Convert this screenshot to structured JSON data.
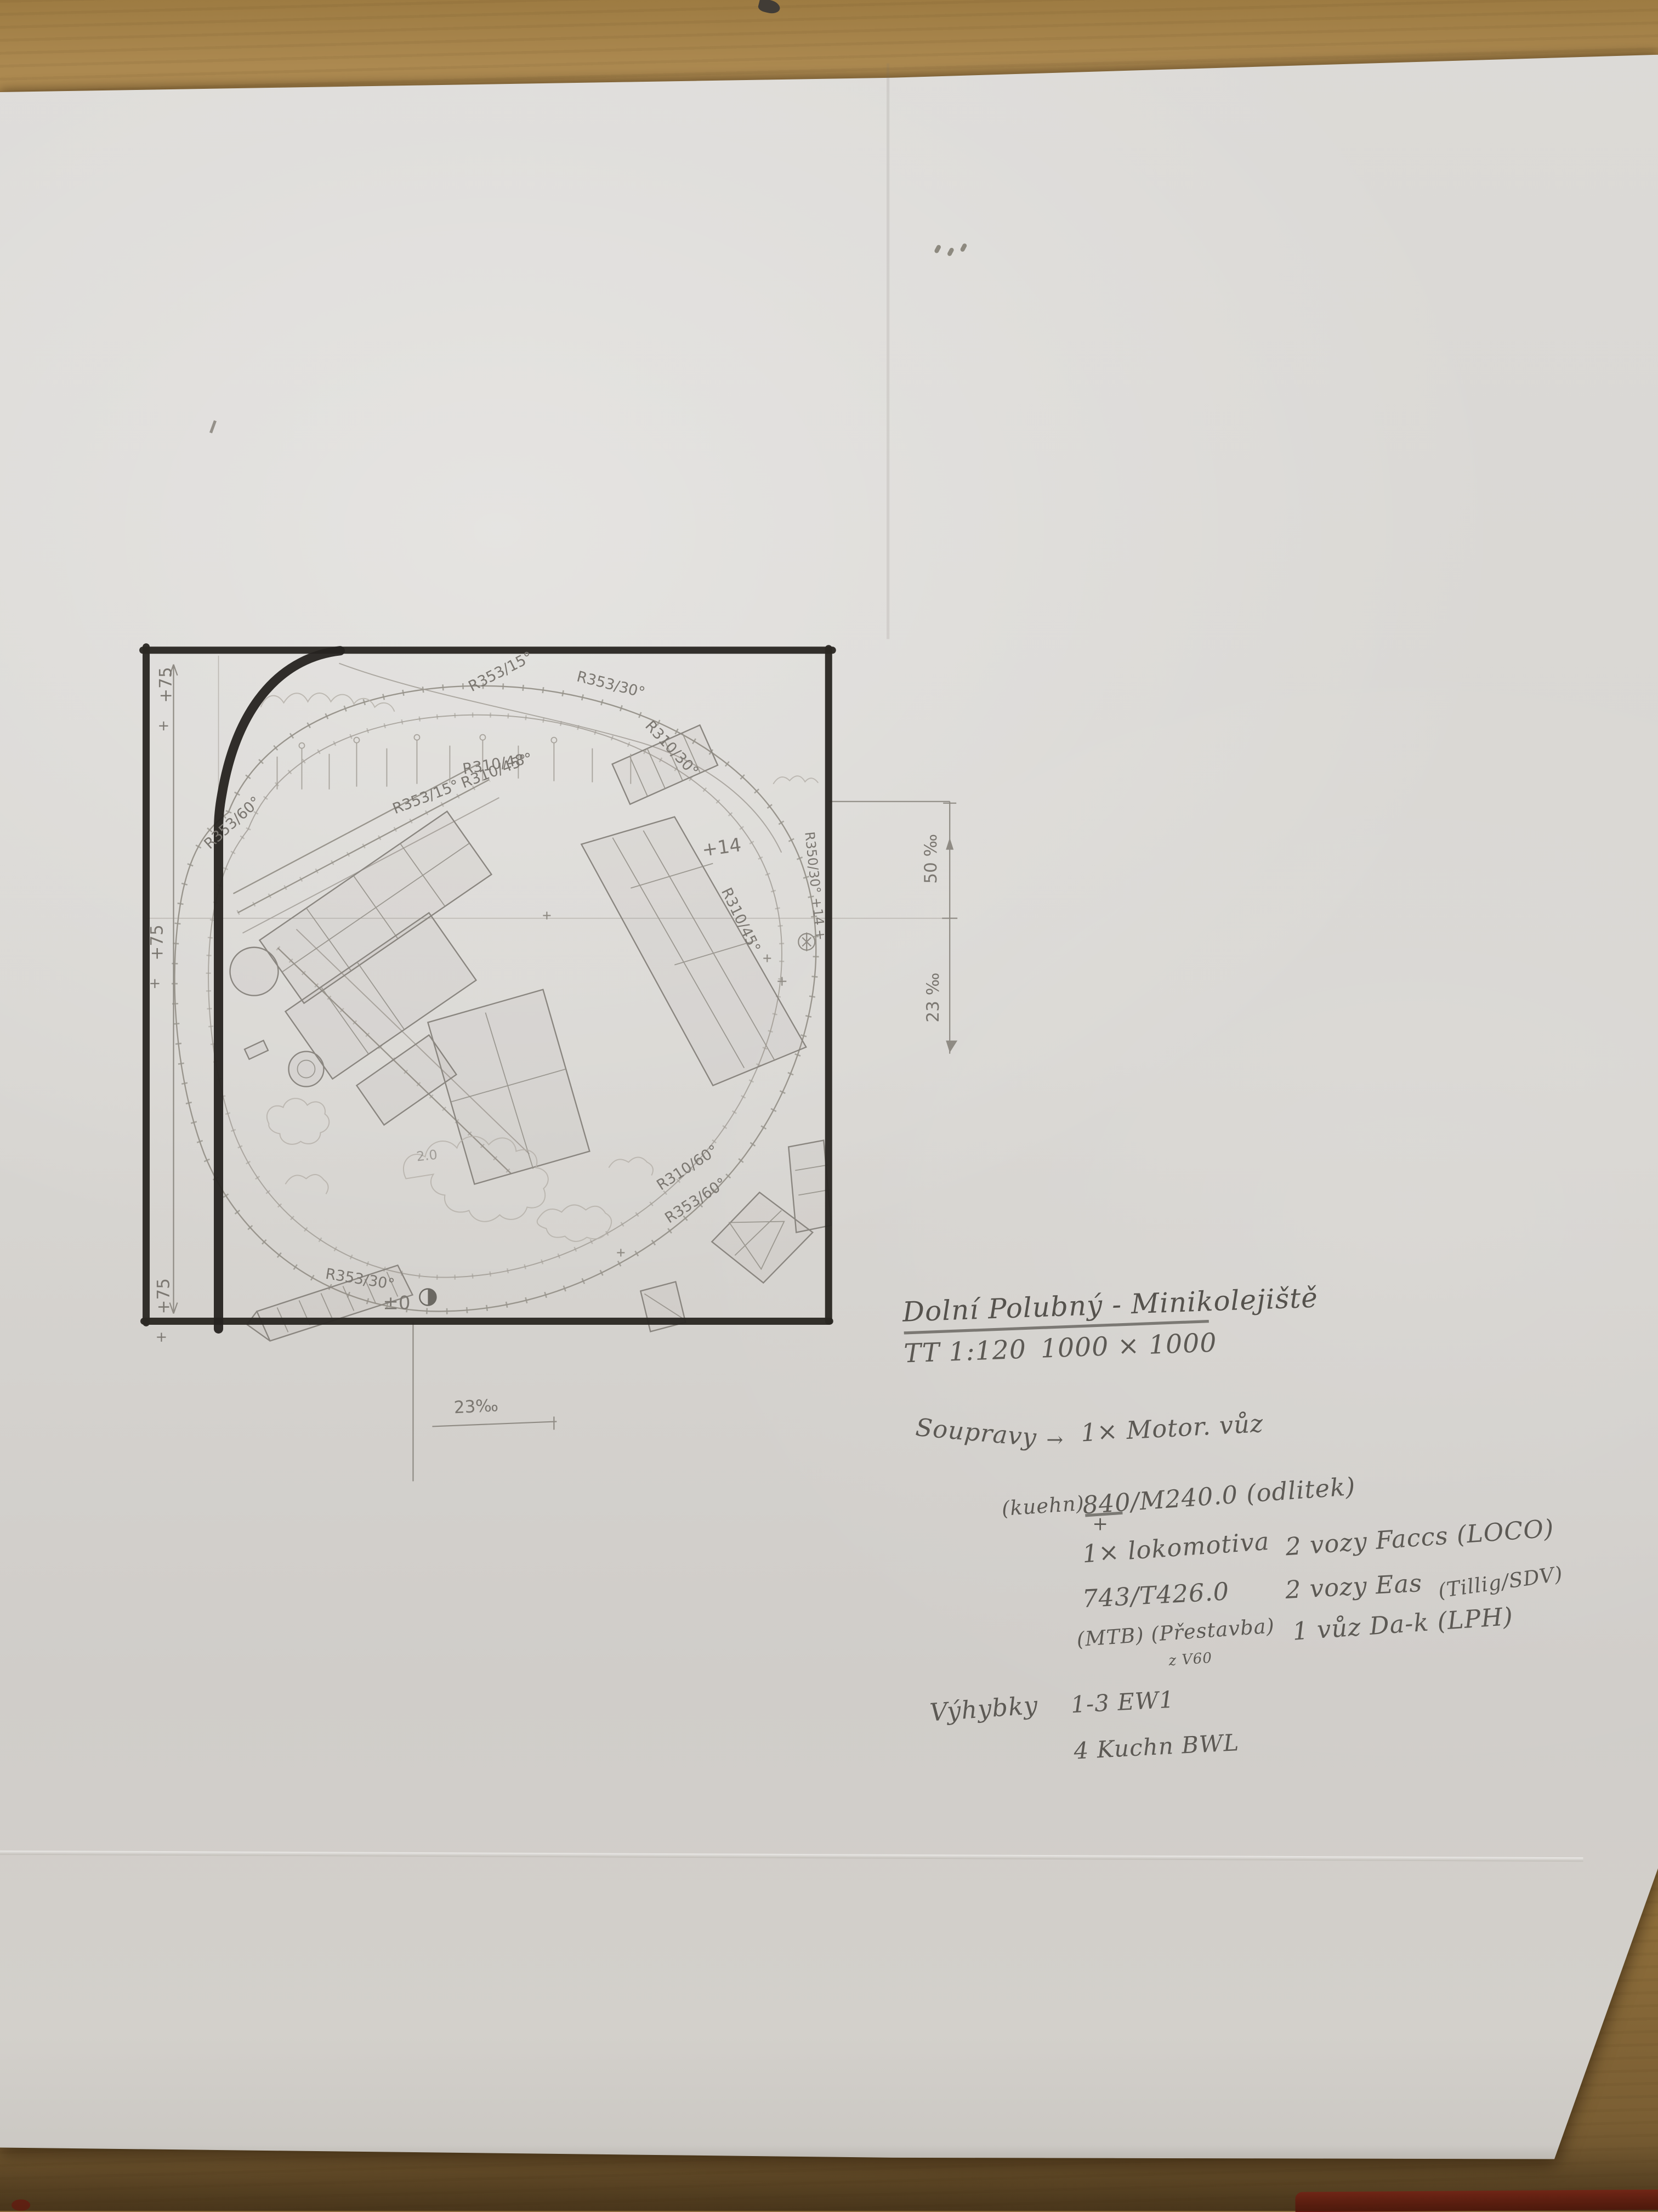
{
  "notes": {
    "title": "Dolní Polubný - Minikolejiště",
    "scale": "TT 1:120",
    "dimensions": "1000 × 1000",
    "sets_label": "Soupravy",
    "arrow": "→",
    "set1": "1× Motor. vůz",
    "set1_brand": "(kuehn)",
    "set1_detail": "840/M240.0 (odlitek)",
    "plus": "+",
    "set2": "1× lokomotiva",
    "set2_detail": "743/T426.0",
    "set2_note": "(MTB) (Přestavba)",
    "set2_note_small": "z V60",
    "wagons1": "2 vozy Faccs (LOCO)",
    "wagons2": "2 vozy Eas",
    "wagons2_brand": "(Tillig/SDV)",
    "wagons3": "1 vůz Da-k (LPH)",
    "turnouts_label": "Výhybky",
    "turnouts1": "1-3 EW1",
    "turnouts2": "4 Kuchn BWL"
  },
  "plan": {
    "radius_labels": [
      "R353/15°",
      "R353/30°",
      "R310/30°",
      "R310/48°",
      "R353/15°",
      "R310/45°",
      "R353/60°",
      "R350/30° +14 +",
      "R310/45°",
      "R310/60°",
      "R353/60°",
      "R353/30°"
    ],
    "elevation_labels": [
      "+75",
      "+75",
      "+75"
    ],
    "plus_marks": [
      "+",
      "+",
      "+"
    ],
    "point_labels": {
      "p14": "+14",
      "zero": "±0",
      "two": "2.0"
    },
    "gradient_labels": {
      "right_upper": "50 ‰",
      "right_lower": "23 ‰",
      "bottom": "23‰"
    },
    "colors": {
      "marker": "#2b2823",
      "pencil": "#8f8b84",
      "paper": "#d7d5d1",
      "wood": "#a98549"
    }
  }
}
